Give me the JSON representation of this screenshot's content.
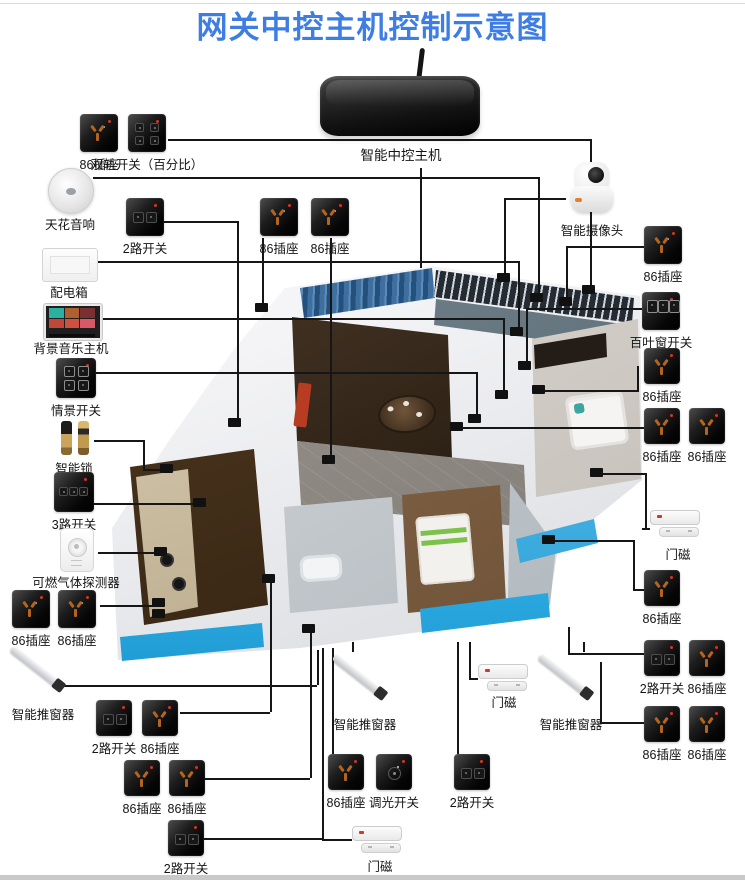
{
  "title": "网关中控主机控制示意图",
  "gateway": {
    "label": "智能中控主机"
  },
  "colors": {
    "title_blue": "#3e7ee4",
    "device_black": "#0c0c0c",
    "socket_pin_orange": "#b5641e",
    "indicator_red": "#e03020",
    "window_glow_blue": "#39b7ec",
    "curtain_blue": "#3e6f9e"
  },
  "legend": {
    "socket": "86插座",
    "switch_2way": "2路开关",
    "switch_3way": "3路开关",
    "dual_rail_switch": "双轨开关（百分比）",
    "scene_switch": "情景开关",
    "dimmer_switch": "调光开关",
    "blinds_switch": "百叶窗开关",
    "ceiling_speaker": "天花音响",
    "distribution_box": "配电箱",
    "music_host": "背景音乐主机",
    "smart_lock": "智能锁",
    "gas_detector": "可燃气体探测器",
    "window_pusher": "智能推窗器",
    "door_sensor": "门磁",
    "camera": "智能摄像头"
  },
  "devices": [
    {
      "kind": "socket",
      "label": "86插座",
      "x": 80,
      "y": 114,
      "w": 38,
      "h": 38
    },
    {
      "kind": "dualrail",
      "label": "双轨开关（百分比）",
      "x": 128,
      "y": 114,
      "w": 38,
      "h": 38
    },
    {
      "kind": "speaker",
      "label": "天花音响",
      "x": 48,
      "y": 168,
      "w": 44,
      "h": 44
    },
    {
      "kind": "switch2",
      "label": "2路开关",
      "x": 126,
      "y": 198,
      "w": 38,
      "h": 38
    },
    {
      "kind": "distbox",
      "label": "配电箱",
      "x": 42,
      "y": 248,
      "w": 54,
      "h": 32
    },
    {
      "kind": "music",
      "label": "背景音乐主机",
      "x": 44,
      "y": 304,
      "w": 54,
      "h": 32
    },
    {
      "kind": "scene",
      "label": "情景开关",
      "x": 56,
      "y": 358,
      "w": 40,
      "h": 40
    },
    {
      "kind": "lock",
      "label": "智能锁",
      "x": 54,
      "y": 420,
      "w": 40,
      "h": 36
    },
    {
      "kind": "switch3",
      "label": "3路开关",
      "x": 54,
      "y": 472,
      "w": 40,
      "h": 40
    },
    {
      "kind": "gas",
      "label": "可燃气体探测器",
      "x": 60,
      "y": 528,
      "w": 32,
      "h": 42
    },
    {
      "kind": "socket",
      "label": "86插座",
      "x": 12,
      "y": 590,
      "w": 38,
      "h": 38
    },
    {
      "kind": "socket",
      "label": "86插座",
      "x": 58,
      "y": 590,
      "w": 38,
      "h": 38
    },
    {
      "kind": "pusher",
      "label": "智能推窗器",
      "x": 8,
      "y": 640,
      "w": 70,
      "h": 62
    },
    {
      "kind": "switch2",
      "label": "2路开关",
      "x": 96,
      "y": 700,
      "w": 36,
      "h": 36
    },
    {
      "kind": "socket",
      "label": "86插座",
      "x": 142,
      "y": 700,
      "w": 36,
      "h": 36
    },
    {
      "kind": "socket",
      "label": "86插座",
      "x": 124,
      "y": 760,
      "w": 36,
      "h": 36
    },
    {
      "kind": "socket",
      "label": "86插座",
      "x": 169,
      "y": 760,
      "w": 36,
      "h": 36
    },
    {
      "kind": "switch2",
      "label": "2路开关",
      "x": 168,
      "y": 820,
      "w": 36,
      "h": 36
    },
    {
      "kind": "socket",
      "label": "86插座",
      "x": 260,
      "y": 198,
      "w": 38,
      "h": 38
    },
    {
      "kind": "socket",
      "label": "86插座",
      "x": 311,
      "y": 198,
      "w": 38,
      "h": 38
    },
    {
      "kind": "camera",
      "label": "智能摄像头",
      "x": 566,
      "y": 162,
      "w": 52,
      "h": 56
    },
    {
      "kind": "socket",
      "label": "86插座",
      "x": 644,
      "y": 226,
      "w": 38,
      "h": 38
    },
    {
      "kind": "blinds",
      "label": "百叶窗开关",
      "x": 642,
      "y": 292,
      "w": 38,
      "h": 38
    },
    {
      "kind": "socket",
      "label": "86插座",
      "x": 644,
      "y": 348,
      "w": 36,
      "h": 36
    },
    {
      "kind": "socket",
      "label": "86插座",
      "x": 644,
      "y": 408,
      "w": 36,
      "h": 36
    },
    {
      "kind": "socket",
      "label": "86插座",
      "x": 689,
      "y": 408,
      "w": 36,
      "h": 36
    },
    {
      "kind": "doorsensor",
      "label": "门磁",
      "x": 650,
      "y": 510,
      "w": 56,
      "h": 32
    },
    {
      "kind": "socket",
      "label": "86插座",
      "x": 644,
      "y": 570,
      "w": 36,
      "h": 36
    },
    {
      "kind": "switch2",
      "label": "2路开关",
      "x": 644,
      "y": 640,
      "w": 36,
      "h": 36
    },
    {
      "kind": "socket",
      "label": "86插座",
      "x": 689,
      "y": 640,
      "w": 36,
      "h": 36
    },
    {
      "kind": "socket",
      "label": "86插座",
      "x": 644,
      "y": 706,
      "w": 36,
      "h": 36
    },
    {
      "kind": "socket",
      "label": "86插座",
      "x": 689,
      "y": 706,
      "w": 36,
      "h": 36
    },
    {
      "kind": "pusher",
      "label": "智能推窗器",
      "x": 330,
      "y": 648,
      "w": 70,
      "h": 64
    },
    {
      "kind": "doorsensor",
      "label": "门磁",
      "x": 478,
      "y": 664,
      "w": 52,
      "h": 26
    },
    {
      "kind": "pusher",
      "label": "智能推窗器",
      "x": 536,
      "y": 648,
      "w": 70,
      "h": 64
    },
    {
      "kind": "socket",
      "label": "86插座",
      "x": 328,
      "y": 754,
      "w": 36,
      "h": 36
    },
    {
      "kind": "dimmer",
      "label": "调光开关",
      "x": 376,
      "y": 754,
      "w": 36,
      "h": 36
    },
    {
      "kind": "switch2",
      "label": "2路开关",
      "x": 454,
      "y": 754,
      "w": 36,
      "h": 36
    },
    {
      "kind": "doorsensor",
      "label": "门磁",
      "x": 352,
      "y": 826,
      "w": 56,
      "h": 28
    }
  ]
}
